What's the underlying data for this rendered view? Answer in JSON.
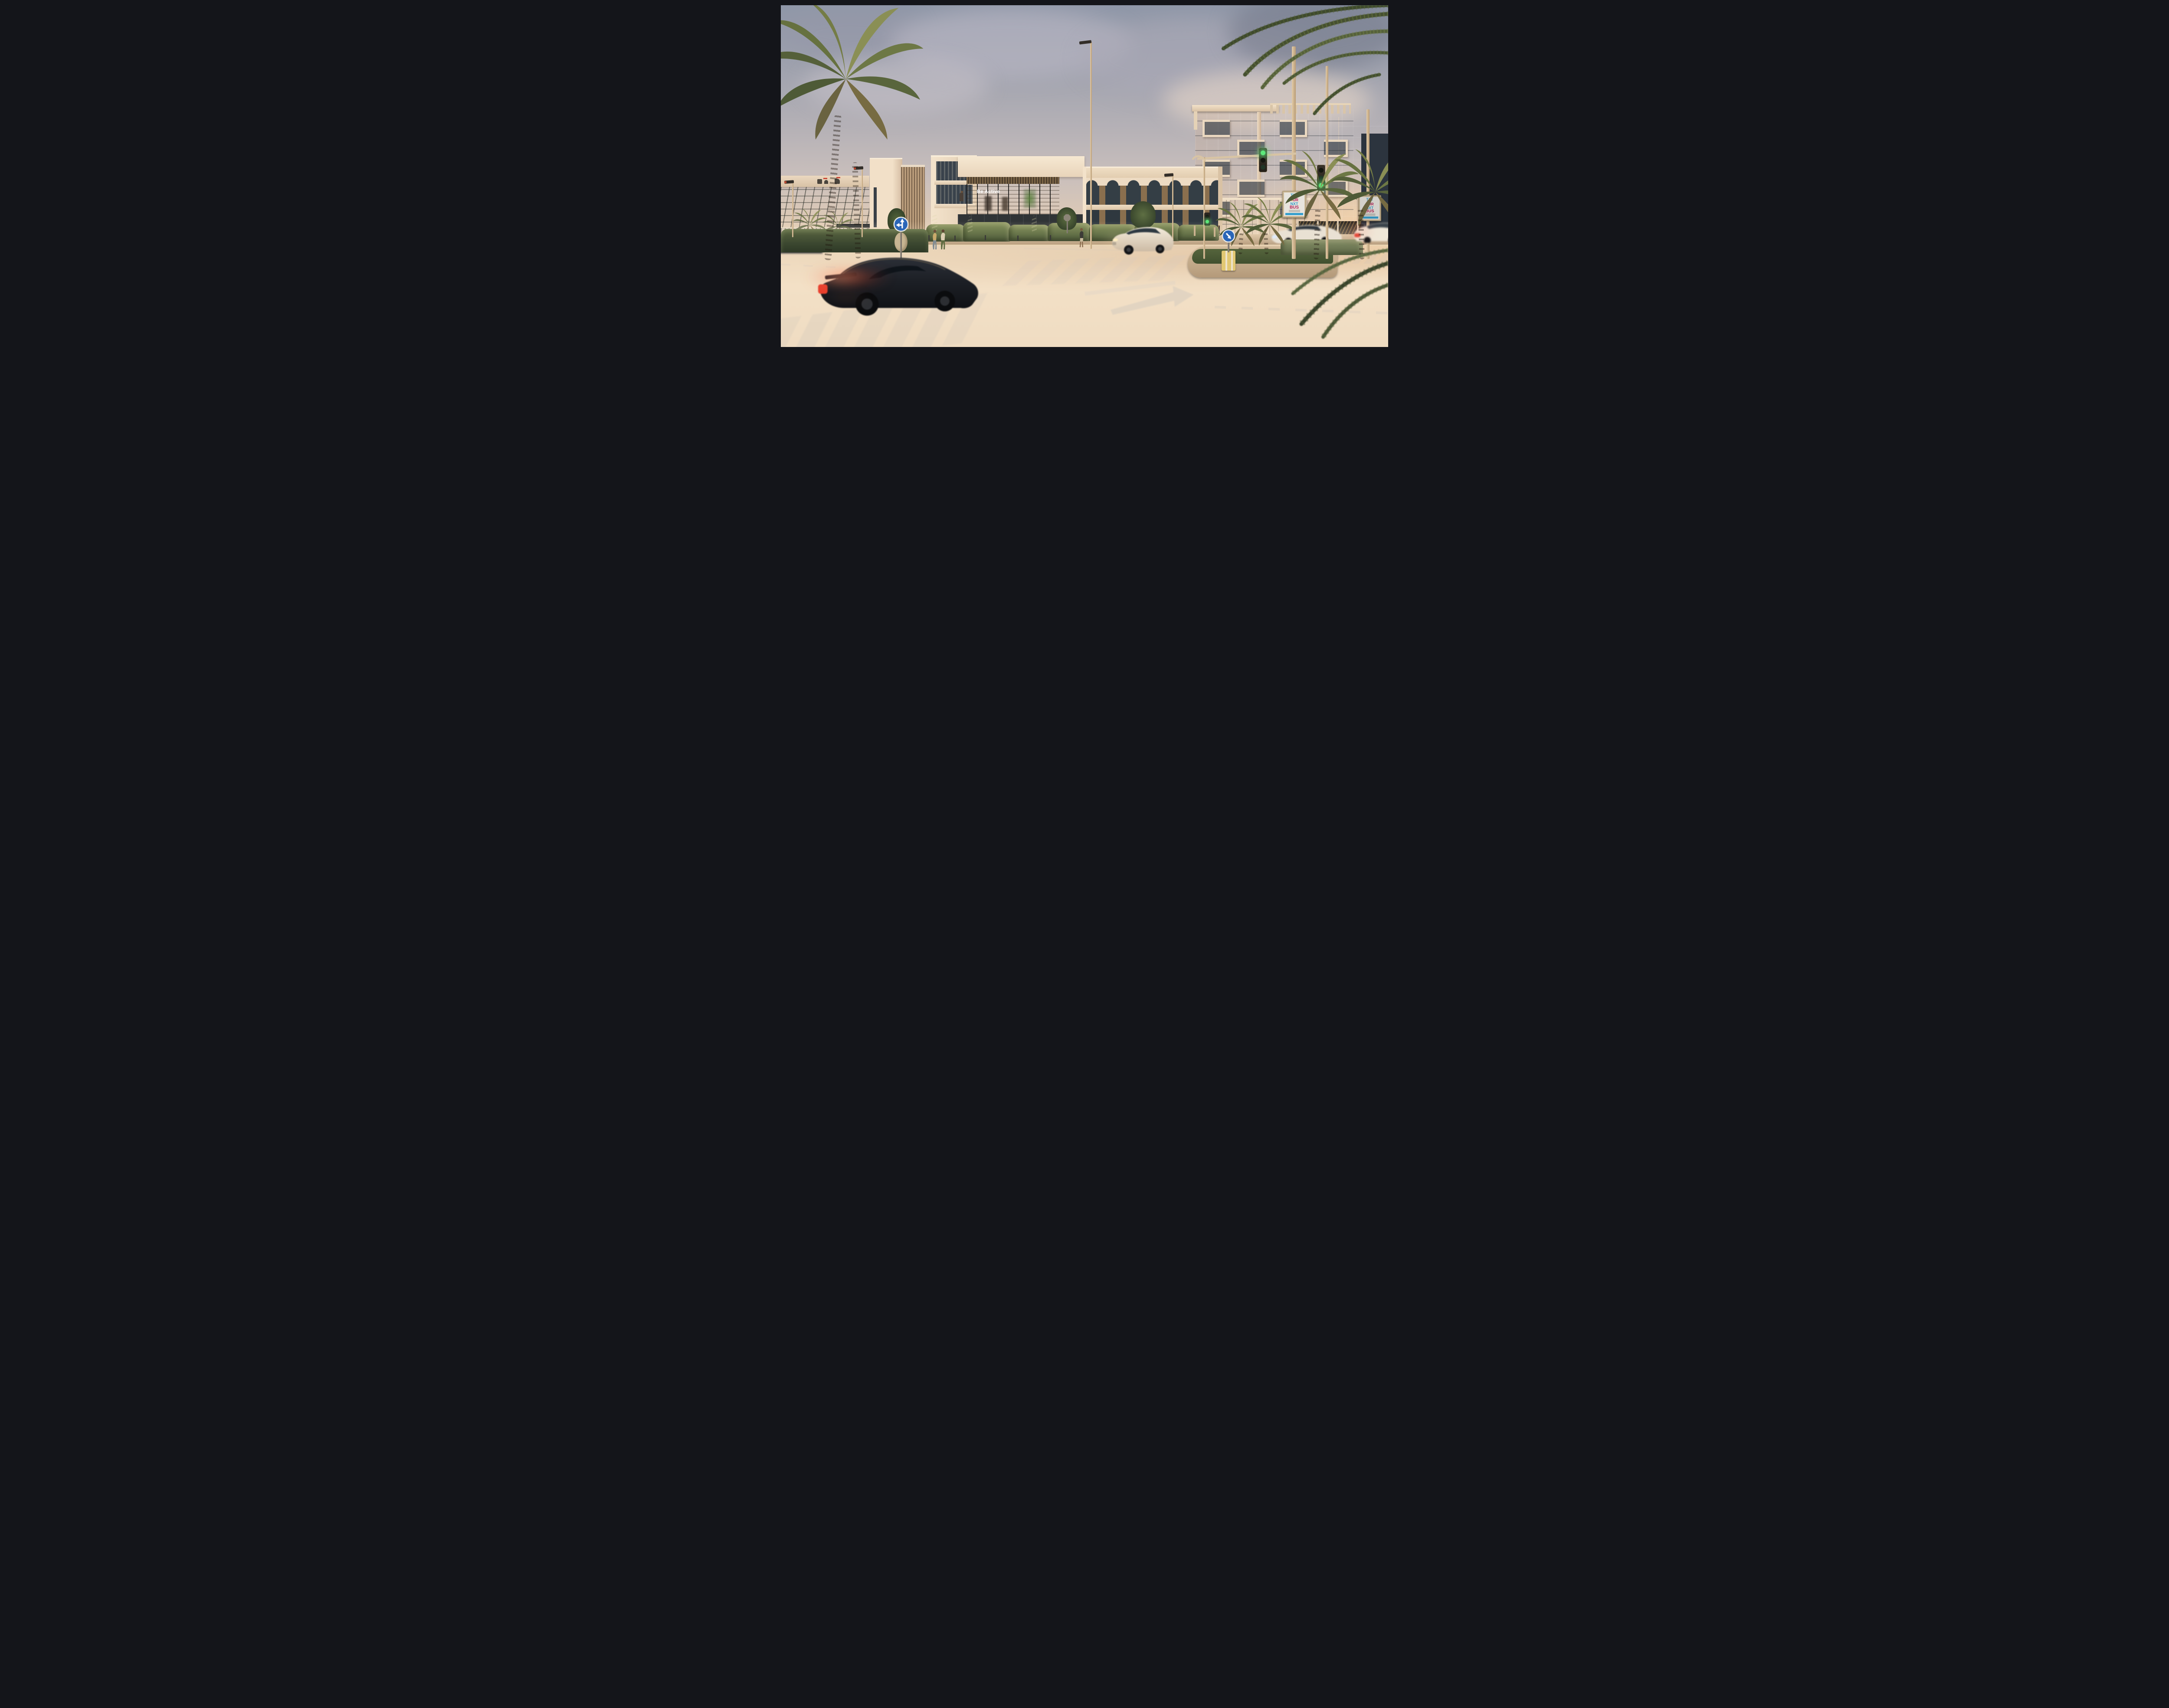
{
  "scene": {
    "description": "Sunset architectural rendering of a cream-coloured modern mixed-use complex at a street intersection, with palm trees, green traffic signals, lamp-post billboards and motion-blurred passing cars",
    "setting": "street intersection at golden hour"
  },
  "buildings": {
    "gym_glass_sign": "Be Active",
    "left_background_logo_icon": "arabic-script-logo",
    "main_complex": "cream low-rise with bronze louvres and arched glazing",
    "right_tower": "glass residential tower with cream balcony frames"
  },
  "billboard": {
    "word1": "TXT",
    "word2_prefix": "4",
    "word2": "UR",
    "word3": "NXT",
    "word4": "BUS",
    "colors": {
      "blue": "#2E9FD4",
      "gold": "#C7A23B",
      "magenta": "#C2205C",
      "banner": "#2FA7DC"
    }
  },
  "traffic_signals": {
    "state": "green",
    "lit_color": "#5CE87A",
    "heads_visible": 3
  },
  "road_signs": [
    {
      "icon": "straight-or-left-arrow-sign",
      "shape": "blue circle"
    },
    {
      "icon": "keep-right-arrow-sign",
      "shape": "blue circle on yellow striped base"
    }
  ],
  "vehicles": {
    "foreground": "dark sports coupe with lit tail-lights",
    "crossing": "white SUV with headlights on",
    "left_behind_hedge": "white SUV with red tail-lights",
    "far_left_edge": "dark sedan",
    "right_median": "white sedan with headlights on",
    "right_edge": "white sedan with red tail-lights"
  },
  "people": {
    "sidewalk_left_pair": 2,
    "sidewalk_center": 1,
    "balcony": 1
  },
  "palette": {
    "sky_top": "#8F97A8",
    "sky_warm": "#F2DFC4",
    "building_cream": "#F1DFC8",
    "louvre_bronze": "#7D6647",
    "glass_dark": "#46525E",
    "hedge_green": "#6E7F4F",
    "palm_green": "#5D6B3F",
    "asphalt": "#3A3734",
    "tail_light_red": "#FF3A26"
  }
}
